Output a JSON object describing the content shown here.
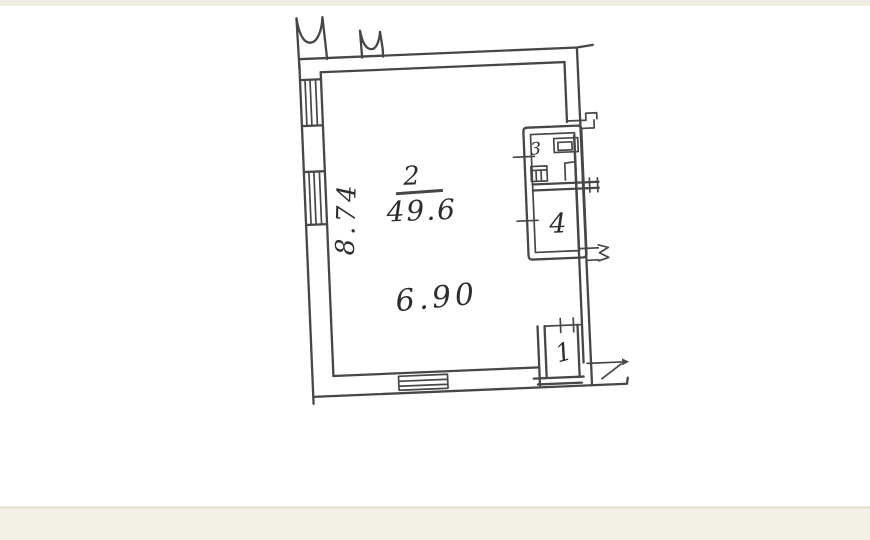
{
  "document": {
    "type": "scanned-floor-plan",
    "ink_color": "#474747",
    "handwriting_color": "#2d2d2d",
    "paper_color": "#ffffff",
    "band_top_color": "#f0ede2",
    "band_bottom_color": "#f3f0e8",
    "band_edge_color": "#e9e5da"
  },
  "plan": {
    "rooms": {
      "main": {
        "number": "2",
        "area": "49.6"
      },
      "wc": {
        "number": "3"
      },
      "bath": {
        "number": "4"
      },
      "entry": {
        "number": "1"
      }
    },
    "dimensions": {
      "width": "6.90",
      "height": "8.74"
    }
  }
}
